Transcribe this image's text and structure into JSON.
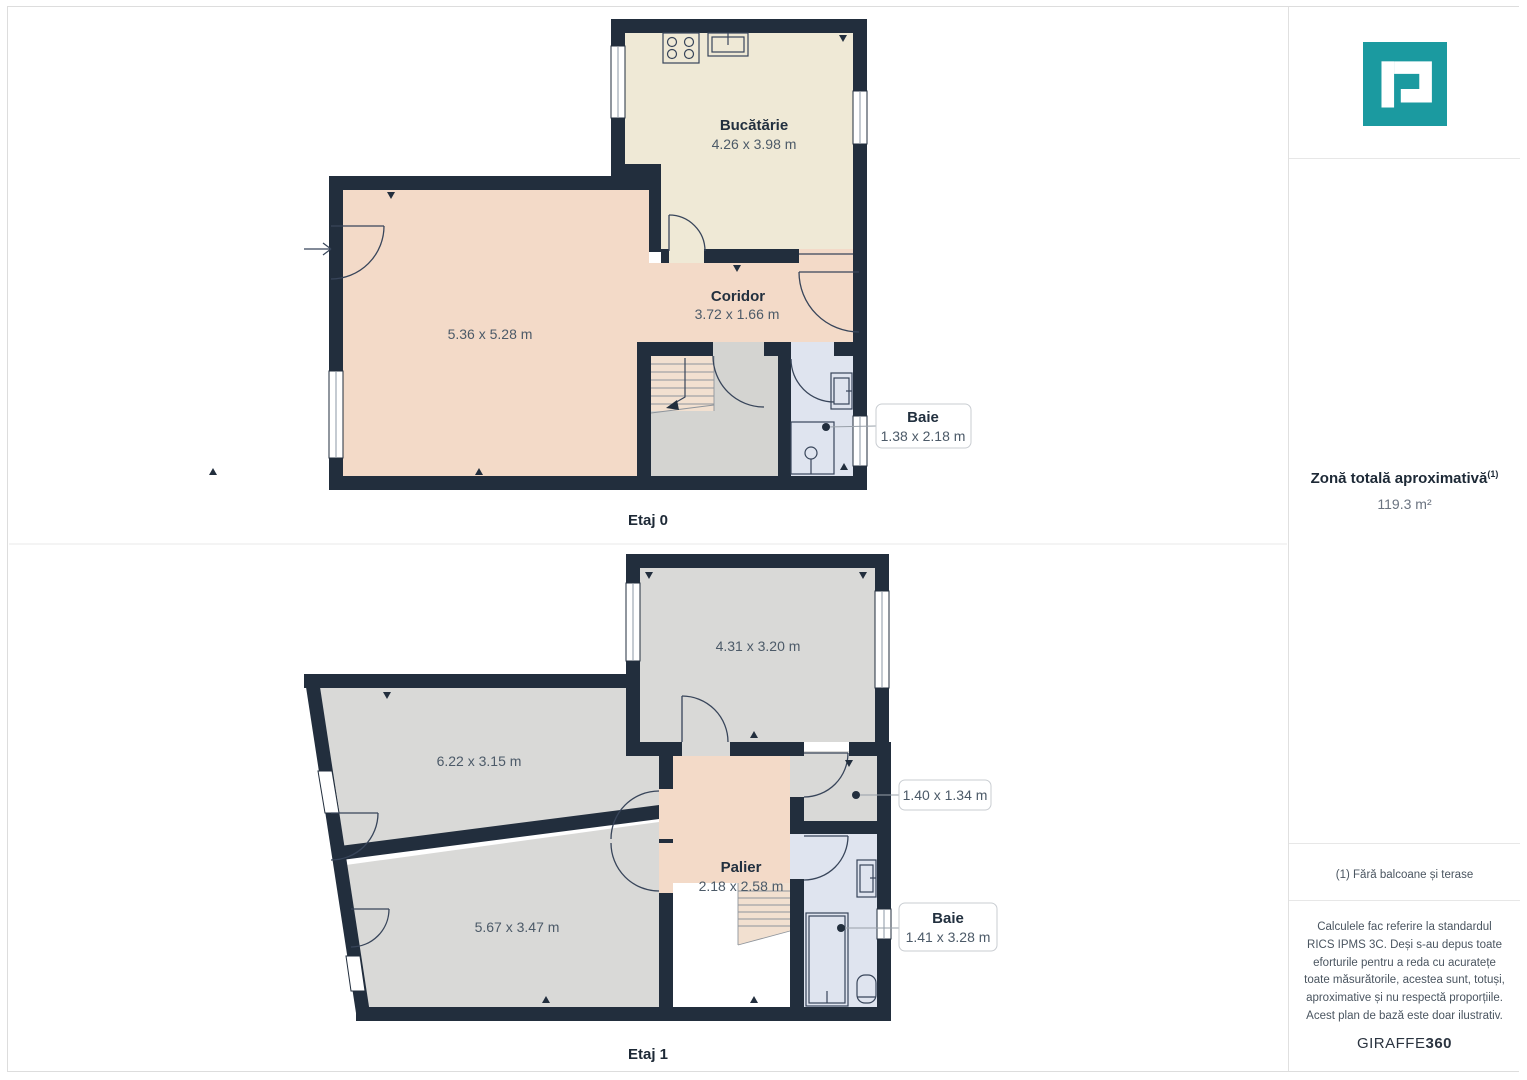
{
  "floor0": {
    "label": "Etaj 0",
    "kitchen_name": "Bucătărie",
    "kitchen_dims": "4.26 x 3.98 m",
    "living_dims": "5.36 x 5.28 m",
    "corridor_name": "Coridor",
    "corridor_dims": "3.72 x 1.66 m",
    "bath_name": "Baie",
    "bath_dims": "1.38 x 2.18 m"
  },
  "floor1": {
    "label": "Etaj 1",
    "room_top_dims": "4.31 x 3.20 m",
    "room_left_dims": "6.22 x 3.15 m",
    "room_bottom_dims": "5.67 x 3.47 m",
    "palier_name": "Palier",
    "palier_dims": "2.18 x 2.58 m",
    "small_room_dims": "1.40 x 1.34 m",
    "bath_name": "Baie",
    "bath_dims": "1.41 x 3.28 m"
  },
  "sidebar": {
    "area_title": "Zonă totală aproximativă",
    "area_title_sup": "(1)",
    "area_value": "119.3 m²",
    "footnote": "(1) Fără balcoane și terase",
    "disclaimer": "Calculele fac referire la standardul RICS IPMS 3C. Deși s-au depus toate eforturile pentru a reda cu acuratețe toate măsurătorile, acestea sunt, totuși, aproximative și nu respectă proporțiile. Acest plan de bază este doar ilustrativ.",
    "brand_name": "GIRAFFE",
    "brand_suffix": "360",
    "brand_color": "#1b9aa0",
    "wall_color": "#222e3d"
  }
}
